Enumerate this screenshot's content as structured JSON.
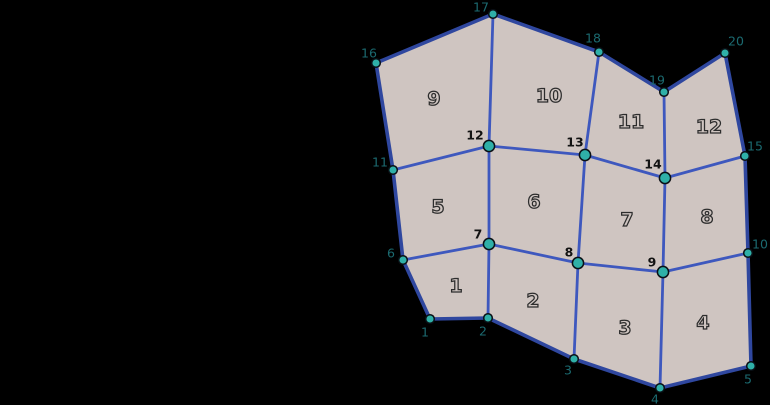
{
  "figure": {
    "background": "#000000",
    "mesh": {
      "colors": {
        "face_fill": "#cfc5c1",
        "interior_edge": "#3e58be",
        "boundary_edge": "#2f479f",
        "vertex_fill": "#2fb0a8",
        "vertex_stroke": "#0a1016",
        "boundary_label": "#1b6a70",
        "interior_label": "#121212",
        "face_label_fill": "#cfc5c1",
        "face_label_stroke": "#2d2d2d"
      },
      "style": {
        "interior_edge_width": 2.8,
        "boundary_edge_width": 3.6,
        "boundary_vertex_radius": 4.3,
        "interior_vertex_radius": 5.6,
        "vertex_stroke_width": 1.5,
        "face_label_stroke_width": 1.25
      },
      "vertices": [
        {
          "id": "1",
          "x": 430,
          "y": 319,
          "type": "boundary",
          "label": "1",
          "label_x": 425,
          "label_y": 332
        },
        {
          "id": "2",
          "x": 488,
          "y": 318,
          "type": "boundary",
          "label": "2",
          "label_x": 483,
          "label_y": 331
        },
        {
          "id": "3",
          "x": 574,
          "y": 359,
          "type": "boundary",
          "label": "3",
          "label_x": 568,
          "label_y": 370
        },
        {
          "id": "4",
          "x": 660,
          "y": 388,
          "type": "boundary",
          "label": "4",
          "label_x": 655,
          "label_y": 399
        },
        {
          "id": "5",
          "x": 751,
          "y": 366,
          "type": "boundary",
          "label": "5",
          "label_x": 748,
          "label_y": 379
        },
        {
          "id": "6",
          "x": 403,
          "y": 260,
          "type": "boundary",
          "label": "6",
          "label_x": 391,
          "label_y": 253
        },
        {
          "id": "7",
          "x": 489,
          "y": 244,
          "type": "interior",
          "label": "7",
          "label_x": 478,
          "label_y": 234
        },
        {
          "id": "8",
          "x": 578,
          "y": 263,
          "type": "interior",
          "label": "8",
          "label_x": 569,
          "label_y": 252
        },
        {
          "id": "9",
          "x": 663,
          "y": 272,
          "type": "interior",
          "label": "9",
          "label_x": 652,
          "label_y": 262
        },
        {
          "id": "10",
          "x": 748,
          "y": 253,
          "type": "boundary",
          "label": "10",
          "label_x": 760,
          "label_y": 244
        },
        {
          "id": "11",
          "x": 393,
          "y": 170,
          "type": "boundary",
          "label": "11",
          "label_x": 380,
          "label_y": 162
        },
        {
          "id": "12",
          "x": 489,
          "y": 146,
          "type": "interior",
          "label": "12",
          "label_x": 475,
          "label_y": 135
        },
        {
          "id": "13",
          "x": 585,
          "y": 155,
          "type": "interior",
          "label": "13",
          "label_x": 575,
          "label_y": 142
        },
        {
          "id": "14",
          "x": 665,
          "y": 178,
          "type": "interior",
          "label": "14",
          "label_x": 653,
          "label_y": 164
        },
        {
          "id": "15",
          "x": 745,
          "y": 156,
          "type": "boundary",
          "label": "15",
          "label_x": 755,
          "label_y": 146
        },
        {
          "id": "16",
          "x": 376,
          "y": 63,
          "type": "boundary",
          "label": "16",
          "label_x": 369,
          "label_y": 53
        },
        {
          "id": "17",
          "x": 493,
          "y": 14,
          "type": "boundary",
          "label": "17",
          "label_x": 481,
          "label_y": 7
        },
        {
          "id": "18",
          "x": 599,
          "y": 52,
          "type": "boundary",
          "label": "18",
          "label_x": 593,
          "label_y": 38
        },
        {
          "id": "19",
          "x": 664,
          "y": 92,
          "type": "boundary",
          "label": "19",
          "label_x": 657,
          "label_y": 80
        },
        {
          "id": "20",
          "x": 725,
          "y": 53,
          "type": "boundary",
          "label": "20",
          "label_x": 736,
          "label_y": 41
        }
      ],
      "faces": [
        {
          "id": "1",
          "vertices": [
            "1",
            "2",
            "7",
            "6"
          ],
          "label": "1",
          "label_x": 456,
          "label_y": 286
        },
        {
          "id": "2",
          "vertices": [
            "2",
            "3",
            "8",
            "7"
          ],
          "label": "2",
          "label_x": 533,
          "label_y": 301
        },
        {
          "id": "3",
          "vertices": [
            "3",
            "4",
            "9",
            "8"
          ],
          "label": "3",
          "label_x": 625,
          "label_y": 328
        },
        {
          "id": "4",
          "vertices": [
            "4",
            "5",
            "10",
            "9"
          ],
          "label": "4",
          "label_x": 703,
          "label_y": 323
        },
        {
          "id": "5",
          "vertices": [
            "6",
            "7",
            "12",
            "11"
          ],
          "label": "5",
          "label_x": 438,
          "label_y": 207
        },
        {
          "id": "6",
          "vertices": [
            "7",
            "8",
            "13",
            "12"
          ],
          "label": "6",
          "label_x": 534,
          "label_y": 202
        },
        {
          "id": "7",
          "vertices": [
            "8",
            "9",
            "14",
            "13"
          ],
          "label": "7",
          "label_x": 627,
          "label_y": 220
        },
        {
          "id": "8",
          "vertices": [
            "9",
            "10",
            "15",
            "14"
          ],
          "label": "8",
          "label_x": 707,
          "label_y": 217
        },
        {
          "id": "9",
          "vertices": [
            "11",
            "12",
            "17",
            "16"
          ],
          "label": "9",
          "label_x": 434,
          "label_y": 99
        },
        {
          "id": "10",
          "vertices": [
            "12",
            "13",
            "18",
            "17"
          ],
          "label": "10",
          "label_x": 549,
          "label_y": 96
        },
        {
          "id": "11",
          "vertices": [
            "13",
            "14",
            "19",
            "18"
          ],
          "label": "11",
          "label_x": 631,
          "label_y": 122
        },
        {
          "id": "12",
          "vertices": [
            "14",
            "15",
            "20",
            "19"
          ],
          "label": "12",
          "label_x": 709,
          "label_y": 127
        }
      ]
    }
  }
}
